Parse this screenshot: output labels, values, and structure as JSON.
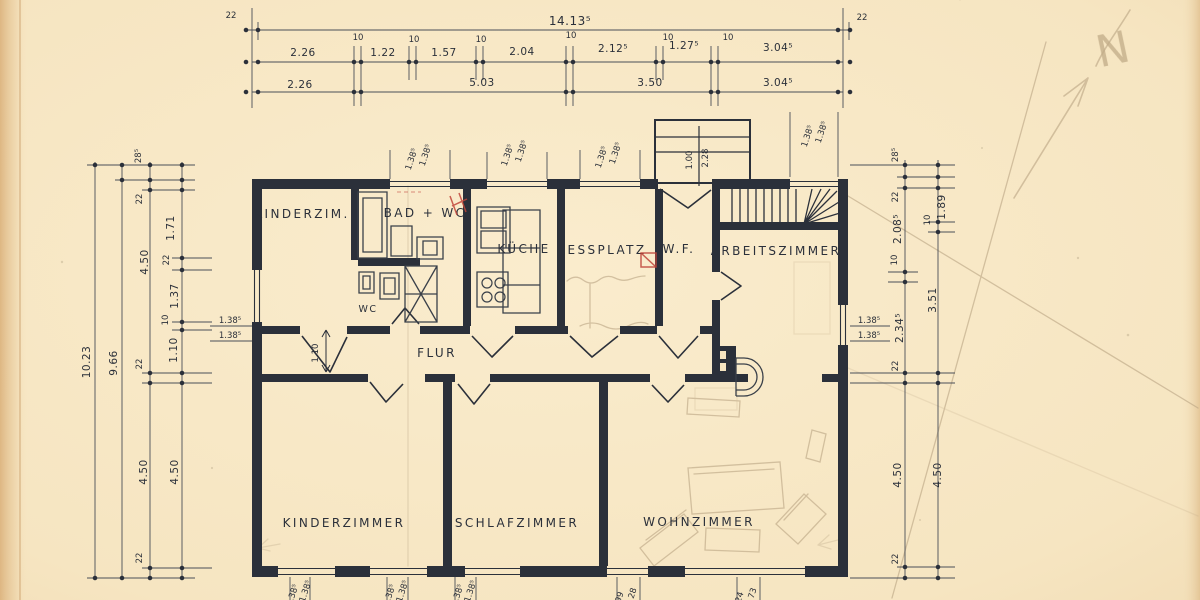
{
  "drawing": {
    "type": "hand-drawn floor plan (scanned blueprint)",
    "rooms": {
      "kinderzim": "KINDERZIM.",
      "bad_wc": "BAD + WC",
      "wc": "WC",
      "kueche": "KÜCHE",
      "essplatz": "ESSPLATZ",
      "wf": "W.F.",
      "arbeitszimmer": "ARBEITSZIMMER",
      "flur": "FLUR",
      "kinderzimmer": "KINDERZIMMER",
      "schlafzimmer": "SCHLAFZIMMER",
      "wohnzimmer": "WOHNZIMMER"
    },
    "dims": {
      "wall": "22",
      "ten": "10",
      "win": "1.38⁵",
      "top": {
        "total": "14.13⁵",
        "row_detail": [
          "2.26",
          "1.22",
          "1.57",
          "2.04",
          "2.12⁵",
          "1.27⁵",
          "3.04⁵"
        ],
        "row_coarse": [
          "2.26",
          "5.03",
          "3.50",
          "3.04⁵"
        ]
      },
      "left": {
        "total": "10.23",
        "inner": "9.66",
        "chain_c": [
          "28⁵",
          "22",
          "4.50",
          "22",
          "4.50",
          "22"
        ],
        "chain_d": [
          "1.71",
          "22",
          "1.37",
          "10",
          "1.10",
          "4.50"
        ]
      },
      "right": {
        "chain_e": [
          "28⁵",
          "22",
          "2.08⁵",
          "10",
          "2.34⁵",
          "22",
          "4.50",
          "22"
        ],
        "chain_f": [
          "1.89",
          "10",
          "3.51",
          "4.50"
        ]
      },
      "entry": {
        "a": "1.00",
        "b": "2.28"
      },
      "flur_clear": "1.10",
      "bottom_partial": [
        "99",
        "28",
        "24",
        "73"
      ]
    },
    "annotations": {
      "north": "N"
    }
  },
  "colors": {
    "paper": "#f6e5c1",
    "ink": "#2b303a",
    "pencil": "#b9a483",
    "red": "#c0453a"
  }
}
